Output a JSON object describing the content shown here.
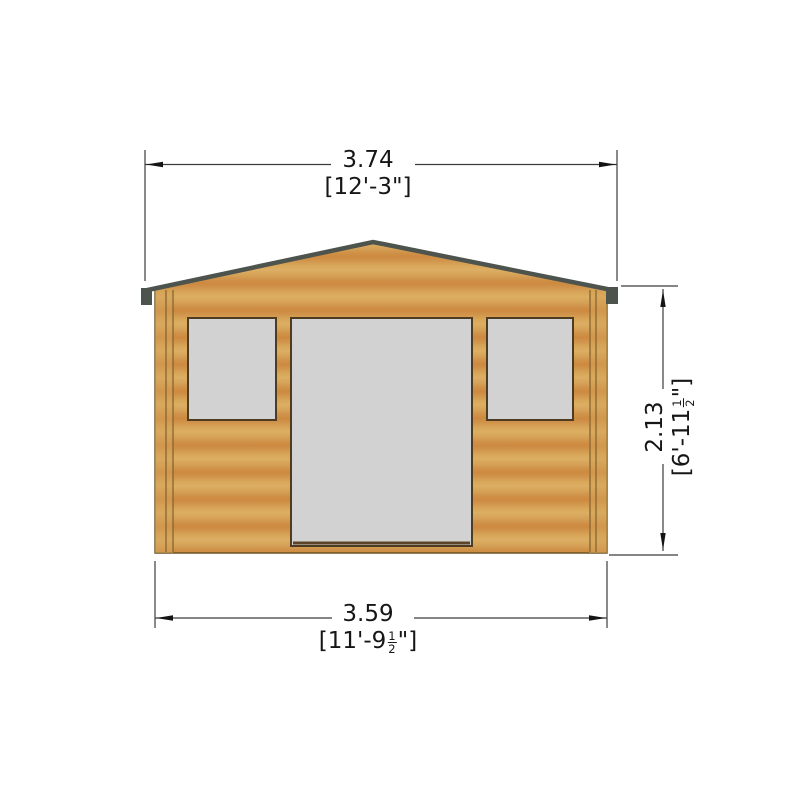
{
  "drawing": {
    "background": "#ffffff",
    "colors": {
      "wood_light": "#dcae63",
      "wood_mid": "#d5a156",
      "wood_dark": "#cd8a40",
      "wood_outline": "#6b5226",
      "corner_board": "#d6a458",
      "fascia": "#4d534d",
      "glass": "#d2d2d2",
      "frame": "#4e3c22",
      "dim_line": "#3c3c3c",
      "arrow": "#141414",
      "text": "#161616"
    }
  },
  "dimensions": {
    "top": {
      "metric": "3.74",
      "imperial": "[12'-3\"]"
    },
    "right": {
      "metric": "2.13",
      "imp_prefix": "[6'-11",
      "frac_num": "1",
      "frac_den": "2",
      "imp_suffix": "\"]"
    },
    "bottom": {
      "metric": "3.59",
      "imp_prefix": "[11'-9",
      "frac_num": "1",
      "frac_den": "2",
      "imp_suffix": "\"]"
    }
  }
}
